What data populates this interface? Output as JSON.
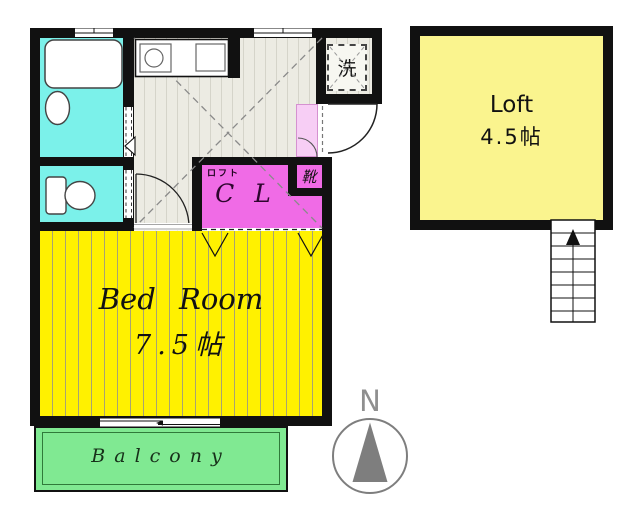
{
  "document_type": "apartment floor plan",
  "colors": {
    "wall": "#111111",
    "wet_rooms_cyan": "#7BF1EA",
    "bedroom_yellow": "#FFF100",
    "loft_yellow": "#FAF48E",
    "closet_magenta": "#F06BE6",
    "entry_pink": "#F7CEF5",
    "balcony_green": "#80E992",
    "floor_gray": "#ECEBE3",
    "compass_gray": "#7E7E7E"
  },
  "rooms": {
    "laundry": {
      "label": "洗"
    },
    "closet": {
      "loft_note": "ロフト",
      "label": "C L"
    },
    "shoe_cabinet": {
      "label": "靴"
    },
    "bedroom": {
      "label": "Bed Room",
      "size": "7.5帖"
    },
    "balcony": {
      "label": "Balcony"
    },
    "loft": {
      "label": "Loft",
      "size": "4.5帖"
    }
  },
  "compass": {
    "label": "N"
  },
  "fixtures": {
    "icons": [
      "bathtub-icon",
      "washbasin-icon",
      "toilet-icon",
      "kitchen-sink-icon",
      "stove-icon",
      "entrance-door-swing-icon",
      "room-door-swing-icon",
      "folding-door-icon",
      "window-icon",
      "stairs-up-arrow-icon",
      "compass-north-icon",
      "washer-space-icon"
    ]
  }
}
